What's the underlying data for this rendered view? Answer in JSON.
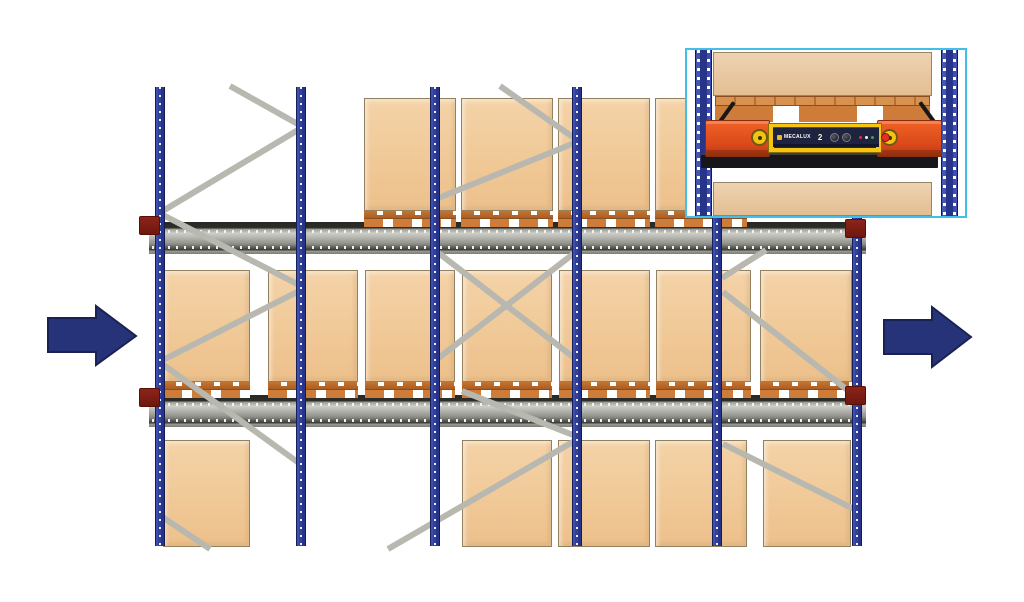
{
  "diagram": {
    "subject": "pallet-shuttle-compact-racking-side-view",
    "levels": 3
  },
  "inset": {
    "brand": "MECALUX",
    "unit_number": "2"
  },
  "colors": {
    "background": "#ffffff",
    "upright_blue": "#2c3b93",
    "rail_gray": "#a8a8a2",
    "rail_edge_dark": "#272723",
    "box_tan": "#f0c896",
    "box_outline": "#93805e",
    "pallet_orange": "#c97634",
    "brace_gray": "#b8b8b0",
    "bracket_red": "#7e1d13",
    "arrow_navy": "#273379",
    "inset_border_cyan": "#41bfe8",
    "shuttle_orange": "#e85a1e",
    "shuttle_yellow": "#f6c513",
    "shuttle_panel_navy": "#1e2340",
    "shuttle_bar_black": "#17171b"
  },
  "scene": {
    "canvas": {
      "w": 1024,
      "h": 602
    },
    "uprights": {
      "x": [
        155,
        296,
        430,
        572,
        712,
        852
      ],
      "y": 87,
      "w": 10,
      "h": 459
    },
    "rails": [
      {
        "x": 149,
        "y": 222,
        "w": 717,
        "h": 32
      },
      {
        "x": 149,
        "y": 395,
        "w": 717,
        "h": 32
      }
    ],
    "brackets": [
      {
        "x": 139,
        "y": 216
      },
      {
        "x": 139,
        "y": 388
      },
      {
        "x": 845,
        "y": 219
      },
      {
        "x": 845,
        "y": 386
      }
    ],
    "braces": [
      [
        230,
        86,
        303,
        127
      ],
      [
        303,
        127,
        161,
        212
      ],
      [
        161,
        214,
        303,
        287
      ],
      [
        303,
        289,
        161,
        361
      ],
      [
        161,
        363,
        303,
        466
      ],
      [
        158,
        514,
        210,
        549
      ],
      [
        500,
        86,
        577,
        140
      ],
      [
        577,
        142,
        436,
        199
      ],
      [
        436,
        251,
        577,
        360
      ],
      [
        577,
        251,
        436,
        360
      ],
      [
        462,
        391,
        578,
        437
      ],
      [
        578,
        439,
        388,
        549
      ],
      [
        766,
        250,
        722,
        278
      ],
      [
        723,
        292,
        850,
        392
      ],
      [
        723,
        444,
        856,
        510
      ]
    ],
    "rows": [
      {
        "name": "top",
        "box_y": 98,
        "box_h": 113,
        "pallet": true,
        "pallet_h": 16,
        "boxes": [
          {
            "x": 364,
            "w": 92
          },
          {
            "x": 461,
            "w": 92
          },
          {
            "x": 558,
            "w": 92
          },
          {
            "x": 655,
            "w": 92
          }
        ]
      },
      {
        "name": "middle",
        "box_y": 270,
        "box_h": 112,
        "pallet": true,
        "pallet_h": 16,
        "boxes": [
          {
            "x": 163,
            "w": 87
          },
          {
            "x": 268,
            "w": 90
          },
          {
            "x": 365,
            "w": 90
          },
          {
            "x": 462,
            "w": 90
          },
          {
            "x": 559,
            "w": 91
          },
          {
            "x": 656,
            "w": 95
          },
          {
            "x": 760,
            "w": 92
          }
        ]
      },
      {
        "name": "bottom",
        "box_y": 440,
        "box_h": 107,
        "pallet": false,
        "pallet_h": 0,
        "boxes": [
          {
            "x": 163,
            "w": 87
          },
          {
            "x": 462,
            "w": 90
          },
          {
            "x": 558,
            "w": 92
          },
          {
            "x": 655,
            "w": 92
          },
          {
            "x": 763,
            "w": 88
          }
        ]
      }
    ],
    "arrows": [
      {
        "id": "flow-arrow-left",
        "points": "48,318 96,318 96,306 136,336 96,365 96,352 48,352"
      },
      {
        "id": "flow-arrow-right",
        "points": "884,320 932,320 932,307 971,337 932,367 932,354 884,354"
      }
    ]
  }
}
